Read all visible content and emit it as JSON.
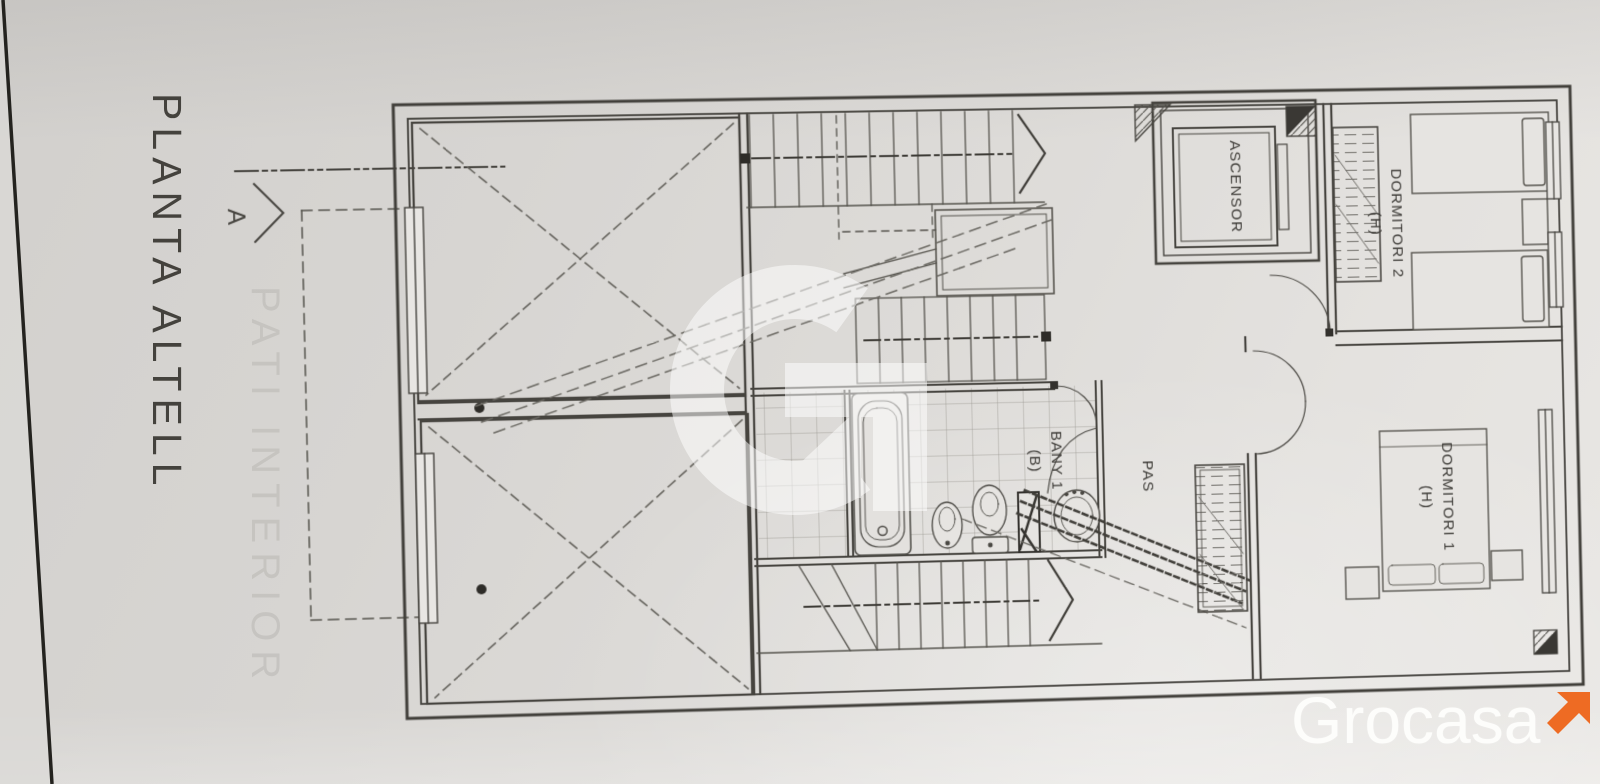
{
  "sheet": {
    "title": "PLANTA ALTELL",
    "section_label": "A",
    "bleed_through_text": "PATI INTERIOR"
  },
  "rooms": {
    "elevator": "ASCENSOR",
    "bedroom2": "DORMITORI 2",
    "bedroom2_tag": "(H)",
    "bedroom1": "DORMITORI 1",
    "bedroom1_tag": "(H)",
    "bathroom": "BANY 1",
    "bathroom_tag": "(B)",
    "hallway": "PAS"
  },
  "branding": {
    "wordmark": "Grocasa",
    "watermark_letter": "G",
    "arrow_color": "#EE6B23",
    "wordmark_color": "#FDFDFB"
  }
}
